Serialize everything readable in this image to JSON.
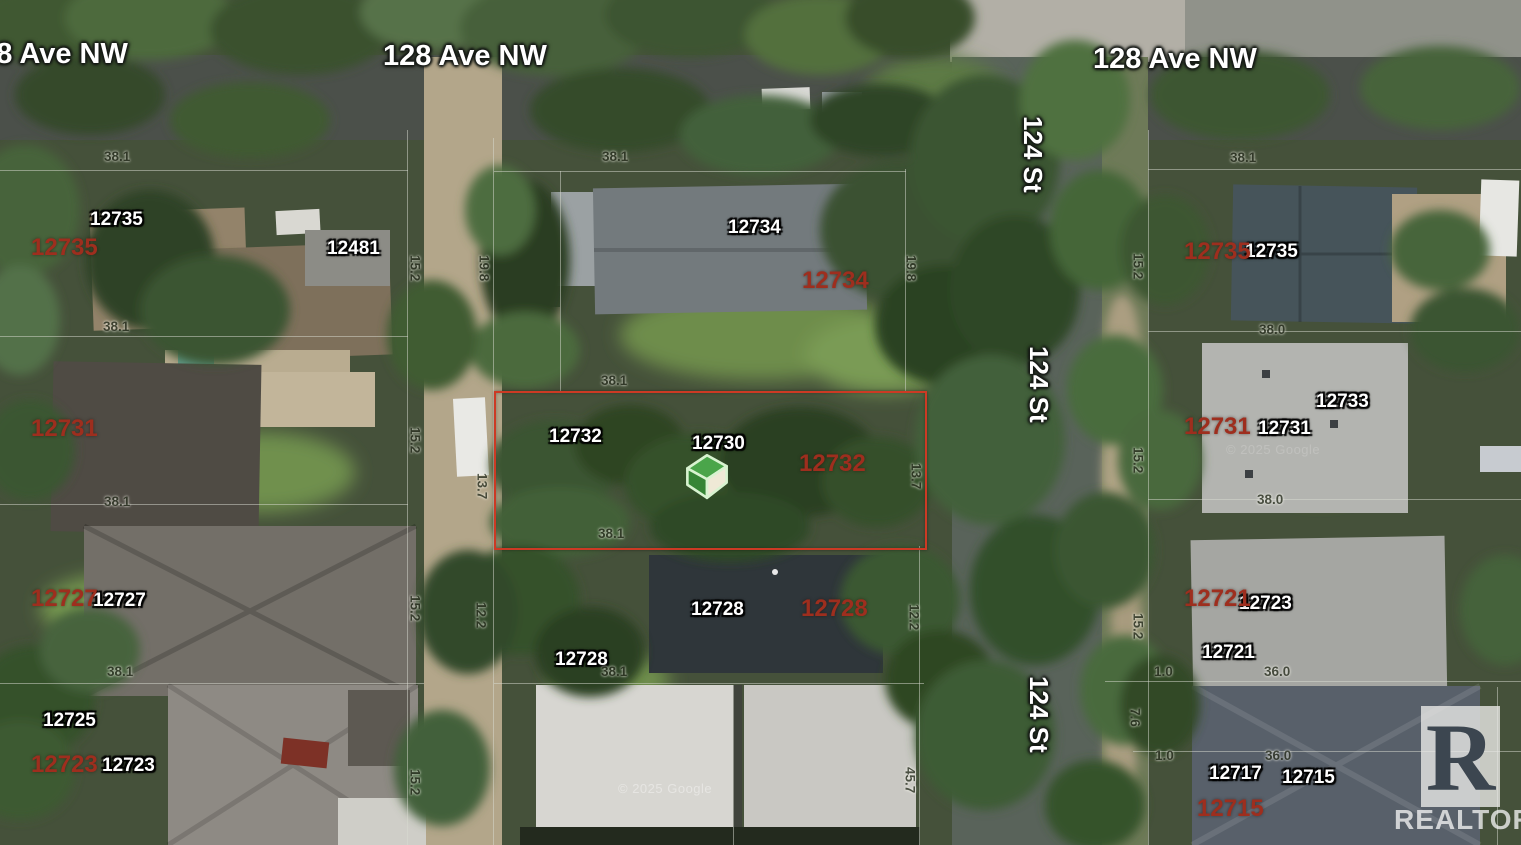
{
  "map": {
    "attribution": "© 2025 Google",
    "brand": {
      "box_letter": "R",
      "label": "REALTOR",
      "reg": "®"
    },
    "subject_outline": {
      "x": 494,
      "y": 391,
      "width": 429,
      "height": 155,
      "color": "#cc3a24"
    },
    "marker": {
      "x": 684,
      "y": 452
    },
    "labels": [
      {
        "type": "street",
        "text": "128 Ave NW",
        "x": -36,
        "y": 40
      },
      {
        "type": "street",
        "text": "128 Ave NW",
        "x": 383,
        "y": 42
      },
      {
        "type": "street",
        "text": "128 Ave NW",
        "x": 1093,
        "y": 45
      },
      {
        "type": "streetv",
        "text": "124 St",
        "x": 1020,
        "y": 116
      },
      {
        "type": "streetv",
        "text": "124 St",
        "x": 1026,
        "y": 346
      },
      {
        "type": "streetv",
        "text": "124 St",
        "x": 1026,
        "y": 676
      },
      {
        "type": "addrw",
        "text": "12735",
        "x": 90,
        "y": 210
      },
      {
        "type": "addrw",
        "text": "12481",
        "x": 327,
        "y": 239
      },
      {
        "type": "addrw",
        "text": "12734",
        "x": 728,
        "y": 218
      },
      {
        "type": "addrw",
        "text": "12732",
        "x": 549,
        "y": 427
      },
      {
        "type": "addrw",
        "text": "12730",
        "x": 692,
        "y": 434
      },
      {
        "type": "addrw",
        "text": "12728",
        "x": 691,
        "y": 600
      },
      {
        "type": "addrw",
        "text": "12728",
        "x": 555,
        "y": 650
      },
      {
        "type": "addrw",
        "text": "12727",
        "x": 93,
        "y": 591
      },
      {
        "type": "addrw",
        "text": "12725",
        "x": 43,
        "y": 711
      },
      {
        "type": "addrw",
        "text": "12723",
        "x": 102,
        "y": 756
      },
      {
        "type": "addrw",
        "text": "12735",
        "x": 1245,
        "y": 242
      },
      {
        "type": "addrw",
        "text": "12733",
        "x": 1316,
        "y": 392
      },
      {
        "type": "addrw",
        "text": "12731",
        "x": 1258,
        "y": 419
      },
      {
        "type": "addrw",
        "text": "12723",
        "x": 1239,
        "y": 594
      },
      {
        "type": "addrw",
        "text": "12721",
        "x": 1202,
        "y": 643
      },
      {
        "type": "addrw",
        "text": "12717",
        "x": 1209,
        "y": 764
      },
      {
        "type": "addrw",
        "text": "12715",
        "x": 1282,
        "y": 768
      },
      {
        "type": "addrr",
        "text": "12735",
        "x": 31,
        "y": 236
      },
      {
        "type": "addrr",
        "text": "12731",
        "x": 31,
        "y": 417
      },
      {
        "type": "addrr",
        "text": "12727",
        "x": 31,
        "y": 587
      },
      {
        "type": "addrr",
        "text": "12723",
        "x": 31,
        "y": 753
      },
      {
        "type": "addrr",
        "text": "12734",
        "x": 802,
        "y": 269
      },
      {
        "type": "addrr",
        "text": "12732",
        "x": 799,
        "y": 452
      },
      {
        "type": "addrr",
        "text": "12728",
        "x": 801,
        "y": 597
      },
      {
        "type": "addrr",
        "text": "12735",
        "x": 1184,
        "y": 240
      },
      {
        "type": "addrr",
        "text": "12731",
        "x": 1184,
        "y": 415
      },
      {
        "type": "addrr",
        "text": "12721",
        "x": 1184,
        "y": 587
      },
      {
        "type": "addrr",
        "text": "12715",
        "x": 1197,
        "y": 797
      },
      {
        "type": "dim",
        "text": "38.1",
        "x": 104,
        "y": 150
      },
      {
        "type": "dim",
        "text": "38.1",
        "x": 602,
        "y": 150
      },
      {
        "type": "dim",
        "text": "38.1",
        "x": 1230,
        "y": 151
      },
      {
        "type": "dim",
        "text": "38.1",
        "x": 103,
        "y": 320
      },
      {
        "type": "dim",
        "text": "38.0",
        "x": 1259,
        "y": 323
      },
      {
        "type": "dim",
        "text": "38.1",
        "x": 601,
        "y": 374
      },
      {
        "type": "dim",
        "text": "38.1",
        "x": 104,
        "y": 495
      },
      {
        "type": "dim",
        "text": "38.0",
        "x": 1257,
        "y": 493
      },
      {
        "type": "dim",
        "text": "38.1",
        "x": 598,
        "y": 527
      },
      {
        "type": "dim",
        "text": "38.1",
        "x": 107,
        "y": 665
      },
      {
        "type": "dim",
        "text": "38.1",
        "x": 601,
        "y": 665
      },
      {
        "type": "dim",
        "text": "1.0",
        "x": 1154,
        "y": 665
      },
      {
        "type": "dim",
        "text": "36.0",
        "x": 1264,
        "y": 665
      },
      {
        "type": "dim",
        "text": "1.0",
        "x": 1155,
        "y": 749
      },
      {
        "type": "dim",
        "text": "36.0",
        "x": 1265,
        "y": 749
      },
      {
        "type": "dimv",
        "text": "15.2",
        "x": 408,
        "y": 255
      },
      {
        "type": "dimv",
        "text": "19.8",
        "x": 477,
        "y": 255
      },
      {
        "type": "dimv",
        "text": "15.2",
        "x": 408,
        "y": 427
      },
      {
        "type": "dimv",
        "text": "13.7",
        "x": 475,
        "y": 473
      },
      {
        "type": "dimv",
        "text": "15.2",
        "x": 408,
        "y": 595
      },
      {
        "type": "dimv",
        "text": "12.2",
        "x": 474,
        "y": 602
      },
      {
        "type": "dimv",
        "text": "15.2",
        "x": 408,
        "y": 769
      },
      {
        "type": "dimv",
        "text": "19.8",
        "x": 904,
        "y": 255
      },
      {
        "type": "dimv",
        "text": "13.7",
        "x": 909,
        "y": 463
      },
      {
        "type": "dimv",
        "text": "12.2",
        "x": 907,
        "y": 604
      },
      {
        "type": "dimv",
        "text": "45.7",
        "x": 903,
        "y": 767
      },
      {
        "type": "dimv",
        "text": "15.2",
        "x": 1131,
        "y": 253
      },
      {
        "type": "dimv",
        "text": "15.2",
        "x": 1131,
        "y": 447
      },
      {
        "type": "dimv",
        "text": "15.2",
        "x": 1131,
        "y": 613
      },
      {
        "type": "dimv",
        "text": "7.6",
        "x": 1128,
        "y": 708
      },
      {
        "type": "wm",
        "text": "© 2025 Google",
        "x": 618,
        "y": 782,
        "opacity": 0.38
      },
      {
        "type": "wm",
        "text": "© 2025 Google",
        "x": 1226,
        "y": 443,
        "opacity": 0.17
      }
    ]
  }
}
